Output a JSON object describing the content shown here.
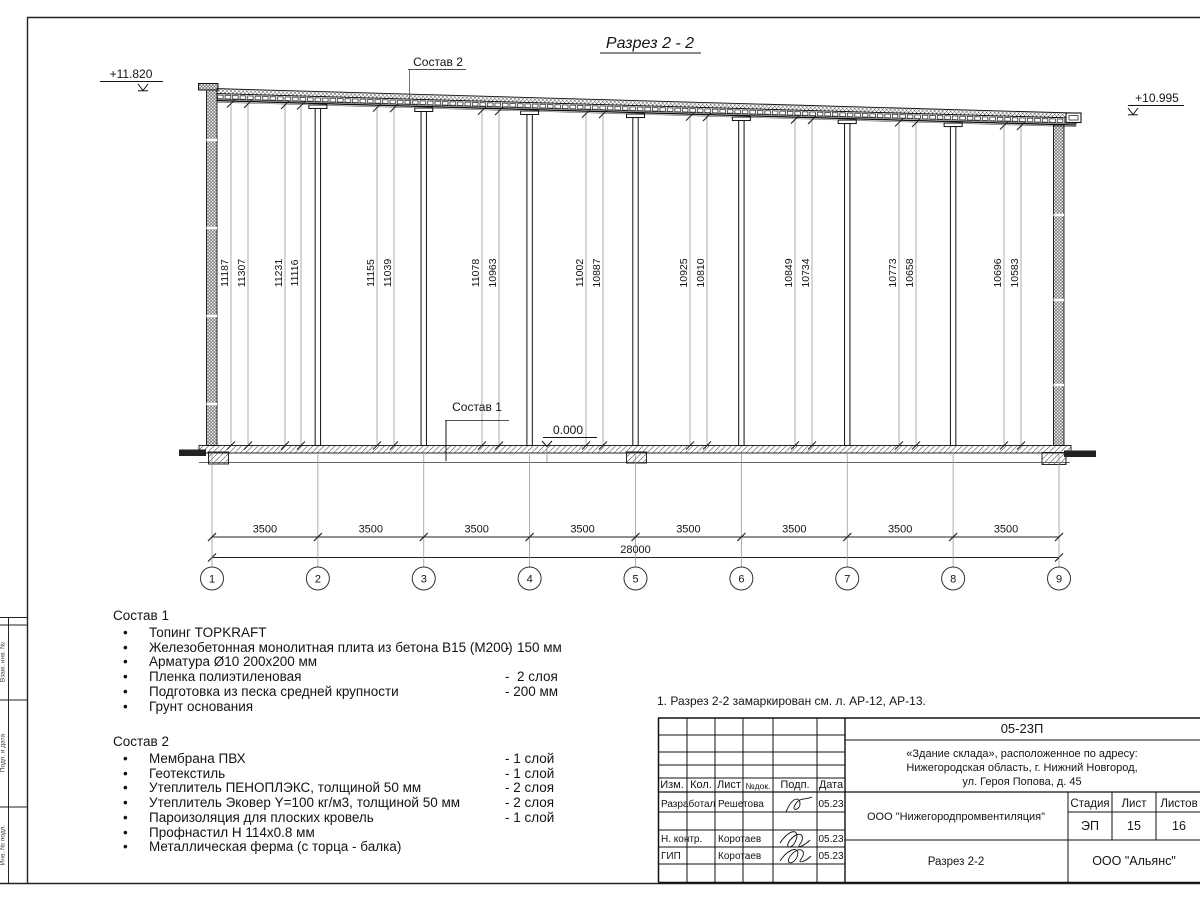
{
  "drawing": {
    "title": "Разрез 2 - 2",
    "elevation_left": "+11.820",
    "elevation_right": "+10.995",
    "elevation_zero": "0.000",
    "sostav1_label": "Состав 1",
    "sostav2_label": "Состав 2",
    "axes": [
      "1",
      "2",
      "3",
      "4",
      "5",
      "6",
      "7",
      "8",
      "9"
    ],
    "bay_dim": "3500",
    "total_dim": "28000",
    "height_dims": [
      {
        "value": "11187",
        "x": 231
      },
      {
        "value": "11307",
        "x": 248
      },
      {
        "value": "11231",
        "x": 285
      },
      {
        "value": "11116",
        "x": 301
      },
      {
        "value": "11155",
        "x": 377
      },
      {
        "value": "11039",
        "x": 394
      },
      {
        "value": "11078",
        "x": 482
      },
      {
        "value": "10963",
        "x": 499
      },
      {
        "value": "11002",
        "x": 586
      },
      {
        "value": "10887",
        "x": 603
      },
      {
        "value": "10925",
        "x": 690
      },
      {
        "value": "10810",
        "x": 707
      },
      {
        "value": "10849",
        "x": 795
      },
      {
        "value": "10734",
        "x": 812
      },
      {
        "value": "10773",
        "x": 899
      },
      {
        "value": "10658",
        "x": 916
      },
      {
        "value": "10696",
        "x": 1004
      },
      {
        "value": "10583",
        "x": 1021
      }
    ]
  },
  "sostav1": {
    "title": "Состав 1",
    "items": [
      {
        "name": "Топинг TOPKRAFT",
        "qty": ""
      },
      {
        "name": "Железобетонная монолитная плита из бетона В15 (М200)",
        "qty": "-  150 мм"
      },
      {
        "name": "Арматура Ø10 200х200 мм",
        "qty": ""
      },
      {
        "name": "Пленка полиэтиленовая",
        "qty": "-  2 слоя"
      },
      {
        "name": "Подготовка из песка средней крупности",
        "qty": "- 200 мм"
      },
      {
        "name": "Грунт основания",
        "qty": ""
      }
    ]
  },
  "sostav2": {
    "title": "Состав 2",
    "items": [
      {
        "name": "Мембрана ПВХ",
        "qty": "- 1 слой"
      },
      {
        "name": "Геотекстиль",
        "qty": "- 1 слой"
      },
      {
        "name": "Утеплитель ПЕНОПЛЭКС, толщиной 50 мм",
        "qty": "- 2 слоя"
      },
      {
        "name": "Утеплитель Эковер Y=100 кг/м3, толщиной 50 мм",
        "qty": "- 2 слоя"
      },
      {
        "name": "Пароизоляция для плоских кровель",
        "qty": "- 1 слой"
      },
      {
        "name": "Профнастил Н 114х0.8 мм",
        "qty": ""
      },
      {
        "name": "Металлическая ферма (с торца - балка)",
        "qty": ""
      }
    ]
  },
  "note": "1. Разрез 2-2 замаркирован см. л. АР-12, АР-13.",
  "frame": {
    "labels": [
      "Взам. инв. №",
      "Подп. и дата",
      "Инв. № подл."
    ]
  },
  "titleblock": {
    "doc_number": "05-23П",
    "project_line1": "«Здание склада», расположенное по адресу:",
    "project_line2": "Нижегородская область, г. Нижний Новгород,",
    "project_line3": "ул. Героя Попова, д. 45",
    "columns": [
      "Изм.",
      "Кол.",
      "Лист",
      "№док.",
      "Подп.",
      "Дата"
    ],
    "rows": [
      {
        "role": "Разработал",
        "name": "Решетова",
        "date": "05.23"
      },
      {
        "role": "Н. контр.",
        "name": "Коротаев",
        "date": "05.23"
      },
      {
        "role": "ГИП",
        "name": "Коротаев",
        "date": "05.23"
      }
    ],
    "org": "ООО \"Нижегородпромвентиляция\"",
    "stage_label": "Стадия",
    "sheet_label": "Лист",
    "sheets_label": "Листов",
    "stage": "ЭП",
    "sheet": "15",
    "sheets": "16",
    "section_name": "Разрез 2-2",
    "contractor": "ООО \"Альянс\""
  }
}
